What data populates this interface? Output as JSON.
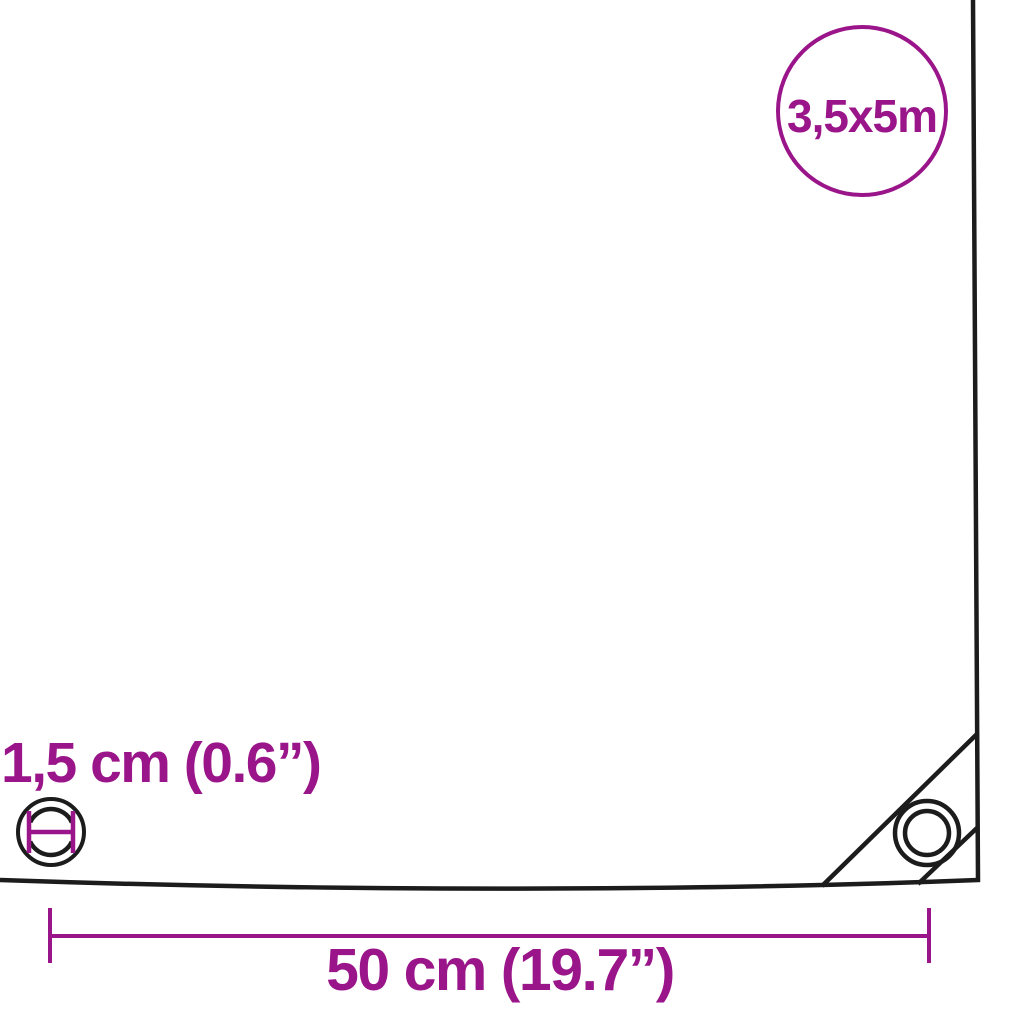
{
  "colors": {
    "accent": "#9a1589",
    "line": "#1c1c1c",
    "background": "#ffffff"
  },
  "size_badge": {
    "label": "3,5x5m",
    "icon": "circle-outline"
  },
  "eyelet_dimension": {
    "label": "1,5 cm (0.6”)",
    "icon": "eyelet-inner-diameter"
  },
  "width_dimension": {
    "label": "50 cm (19.7”)",
    "icon": "horizontal-dimension-line"
  }
}
